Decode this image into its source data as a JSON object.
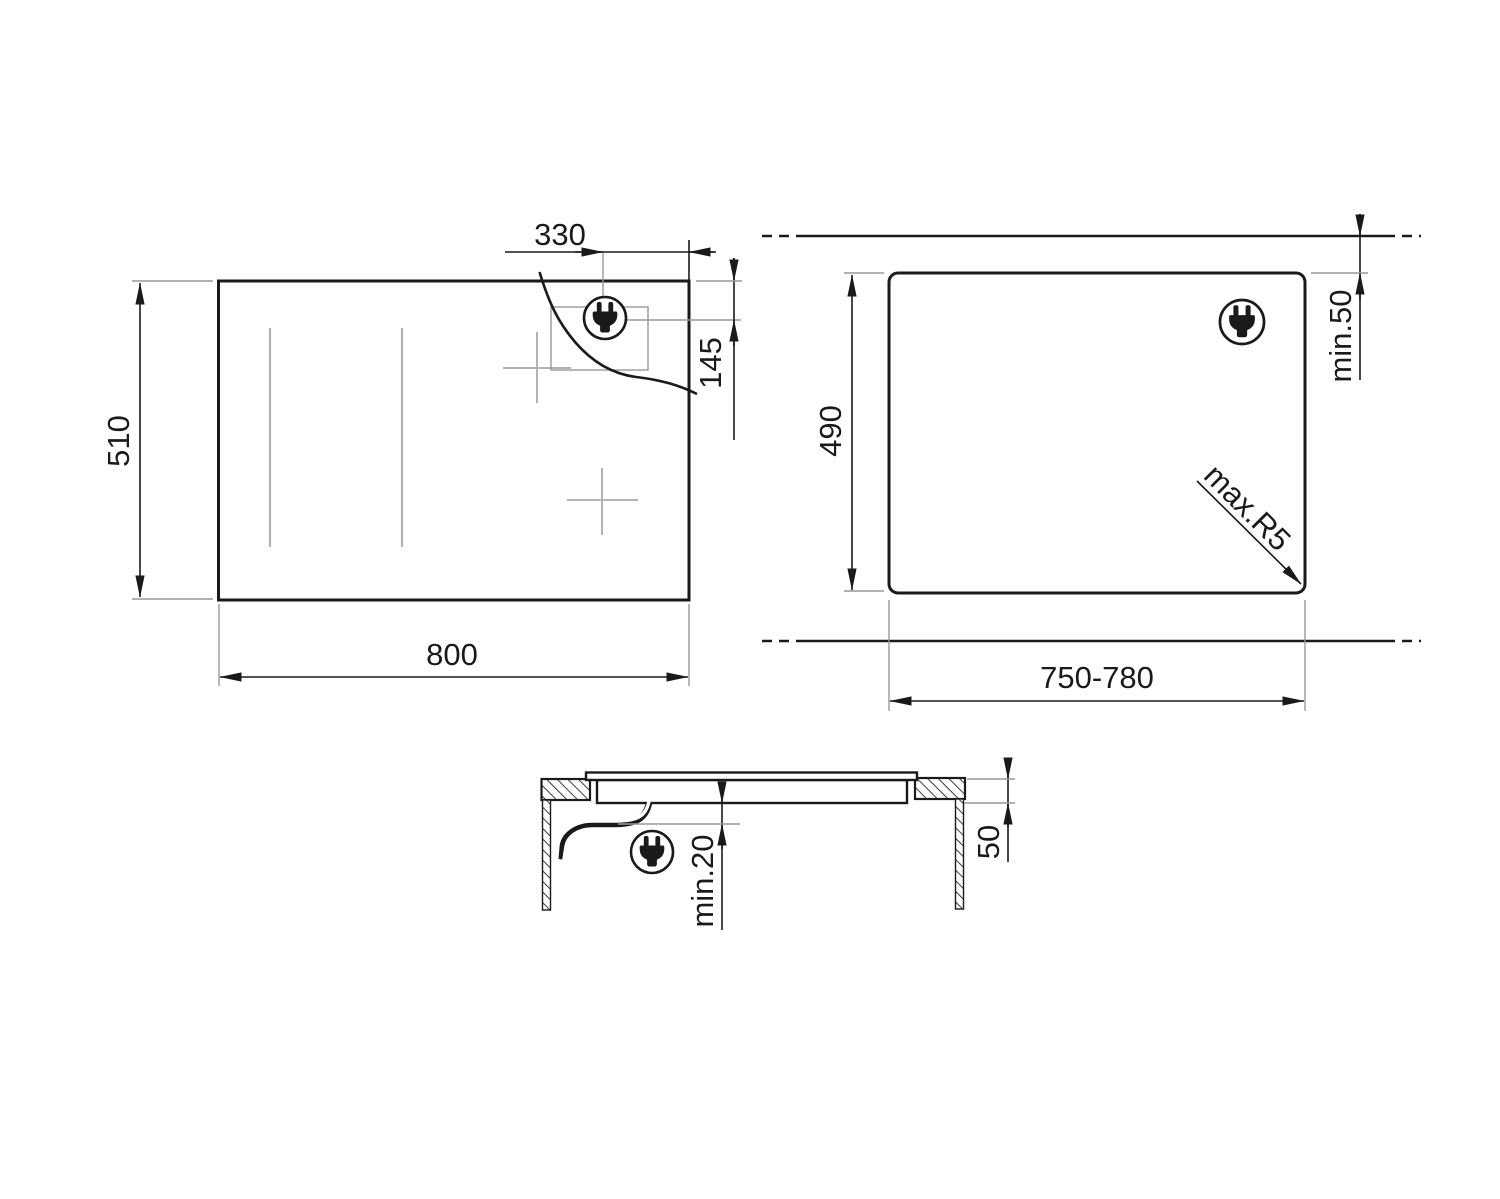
{
  "colors": {
    "line": "#1a1a1a",
    "extension_gray": "#999999",
    "zone_gray": "#b3b3b3",
    "background": "#ffffff"
  },
  "icons": {
    "plug": "power-plug-icon"
  },
  "top_view": {
    "width": "800",
    "height": "510",
    "plug_offset_from_right": "330",
    "plug_offset_from_rear": "145"
  },
  "cutout_view": {
    "cutout_height": "490",
    "cutout_width": "750-780",
    "rear_clearance": "min.50",
    "max_corner_radius": "max.R5"
  },
  "section_view": {
    "min_clearance_below": "min.20",
    "installation_depth": "50"
  }
}
